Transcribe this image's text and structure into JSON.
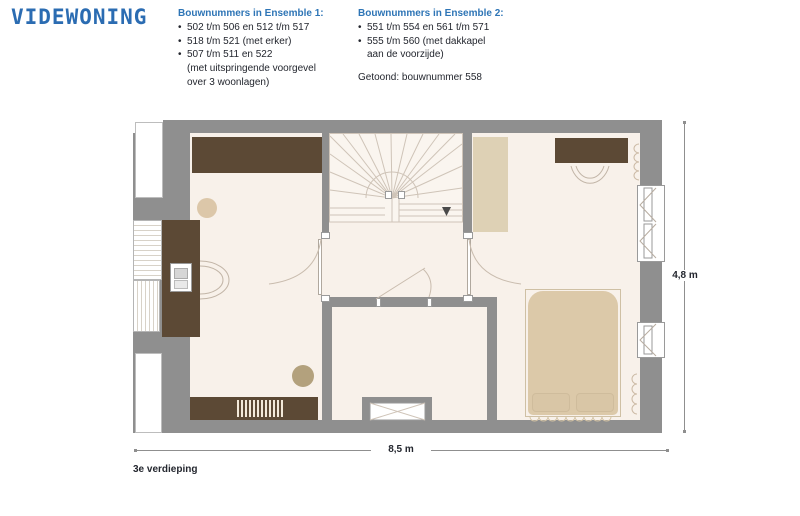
{
  "colors": {
    "logo_blue": "#2b6cb2",
    "heading_blue": "#2e75b6",
    "ink": "#23262e",
    "wall": "#8f8f8f",
    "floor": "#f8f1ea",
    "floor_stair": "#faf5ef",
    "wood_dark": "#5c4935",
    "beige_light": "#ded1b5",
    "bed_beige": "#dcc9a9",
    "stool_beige": "#dcc7a9",
    "pouf_olive": "#b3a17d",
    "line_warm": "#cfc2b4",
    "line_gray": "#9a9a9a",
    "dim_gray": "#8f8f8f"
  },
  "logo": {
    "text": "VIDEWONING"
  },
  "ensemble1": {
    "heading": "Bouwnummers in Ensemble 1:",
    "lines": [
      {
        "b": "•",
        "t": "502 t/m 506 en 512 t/m 517"
      },
      {
        "b": "•",
        "t": "518 t/m 521 (met erker)"
      },
      {
        "b": "•",
        "t": "507 t/m 511 en 522"
      },
      {
        "b": "",
        "t": "(met uitspringende voorgevel"
      },
      {
        "b": "",
        "t": "over 3 woonlagen)"
      }
    ]
  },
  "ensemble2": {
    "heading": "Bouwnummers in Ensemble 2:",
    "lines": [
      {
        "b": "•",
        "t": "551 t/m 554 en 561 t/m 571"
      },
      {
        "b": "•",
        "t": "555 t/m 560 (met dakkapel"
      },
      {
        "b": "",
        "t": "aan de voorzijde)"
      }
    ],
    "note": "Getoond: bouwnummer 558"
  },
  "plan": {
    "floor_label": "3e verdieping",
    "dim_width": "8,5 m",
    "dim_height": "4,8 m",
    "stair_arrow_icon": "down-arrow"
  }
}
